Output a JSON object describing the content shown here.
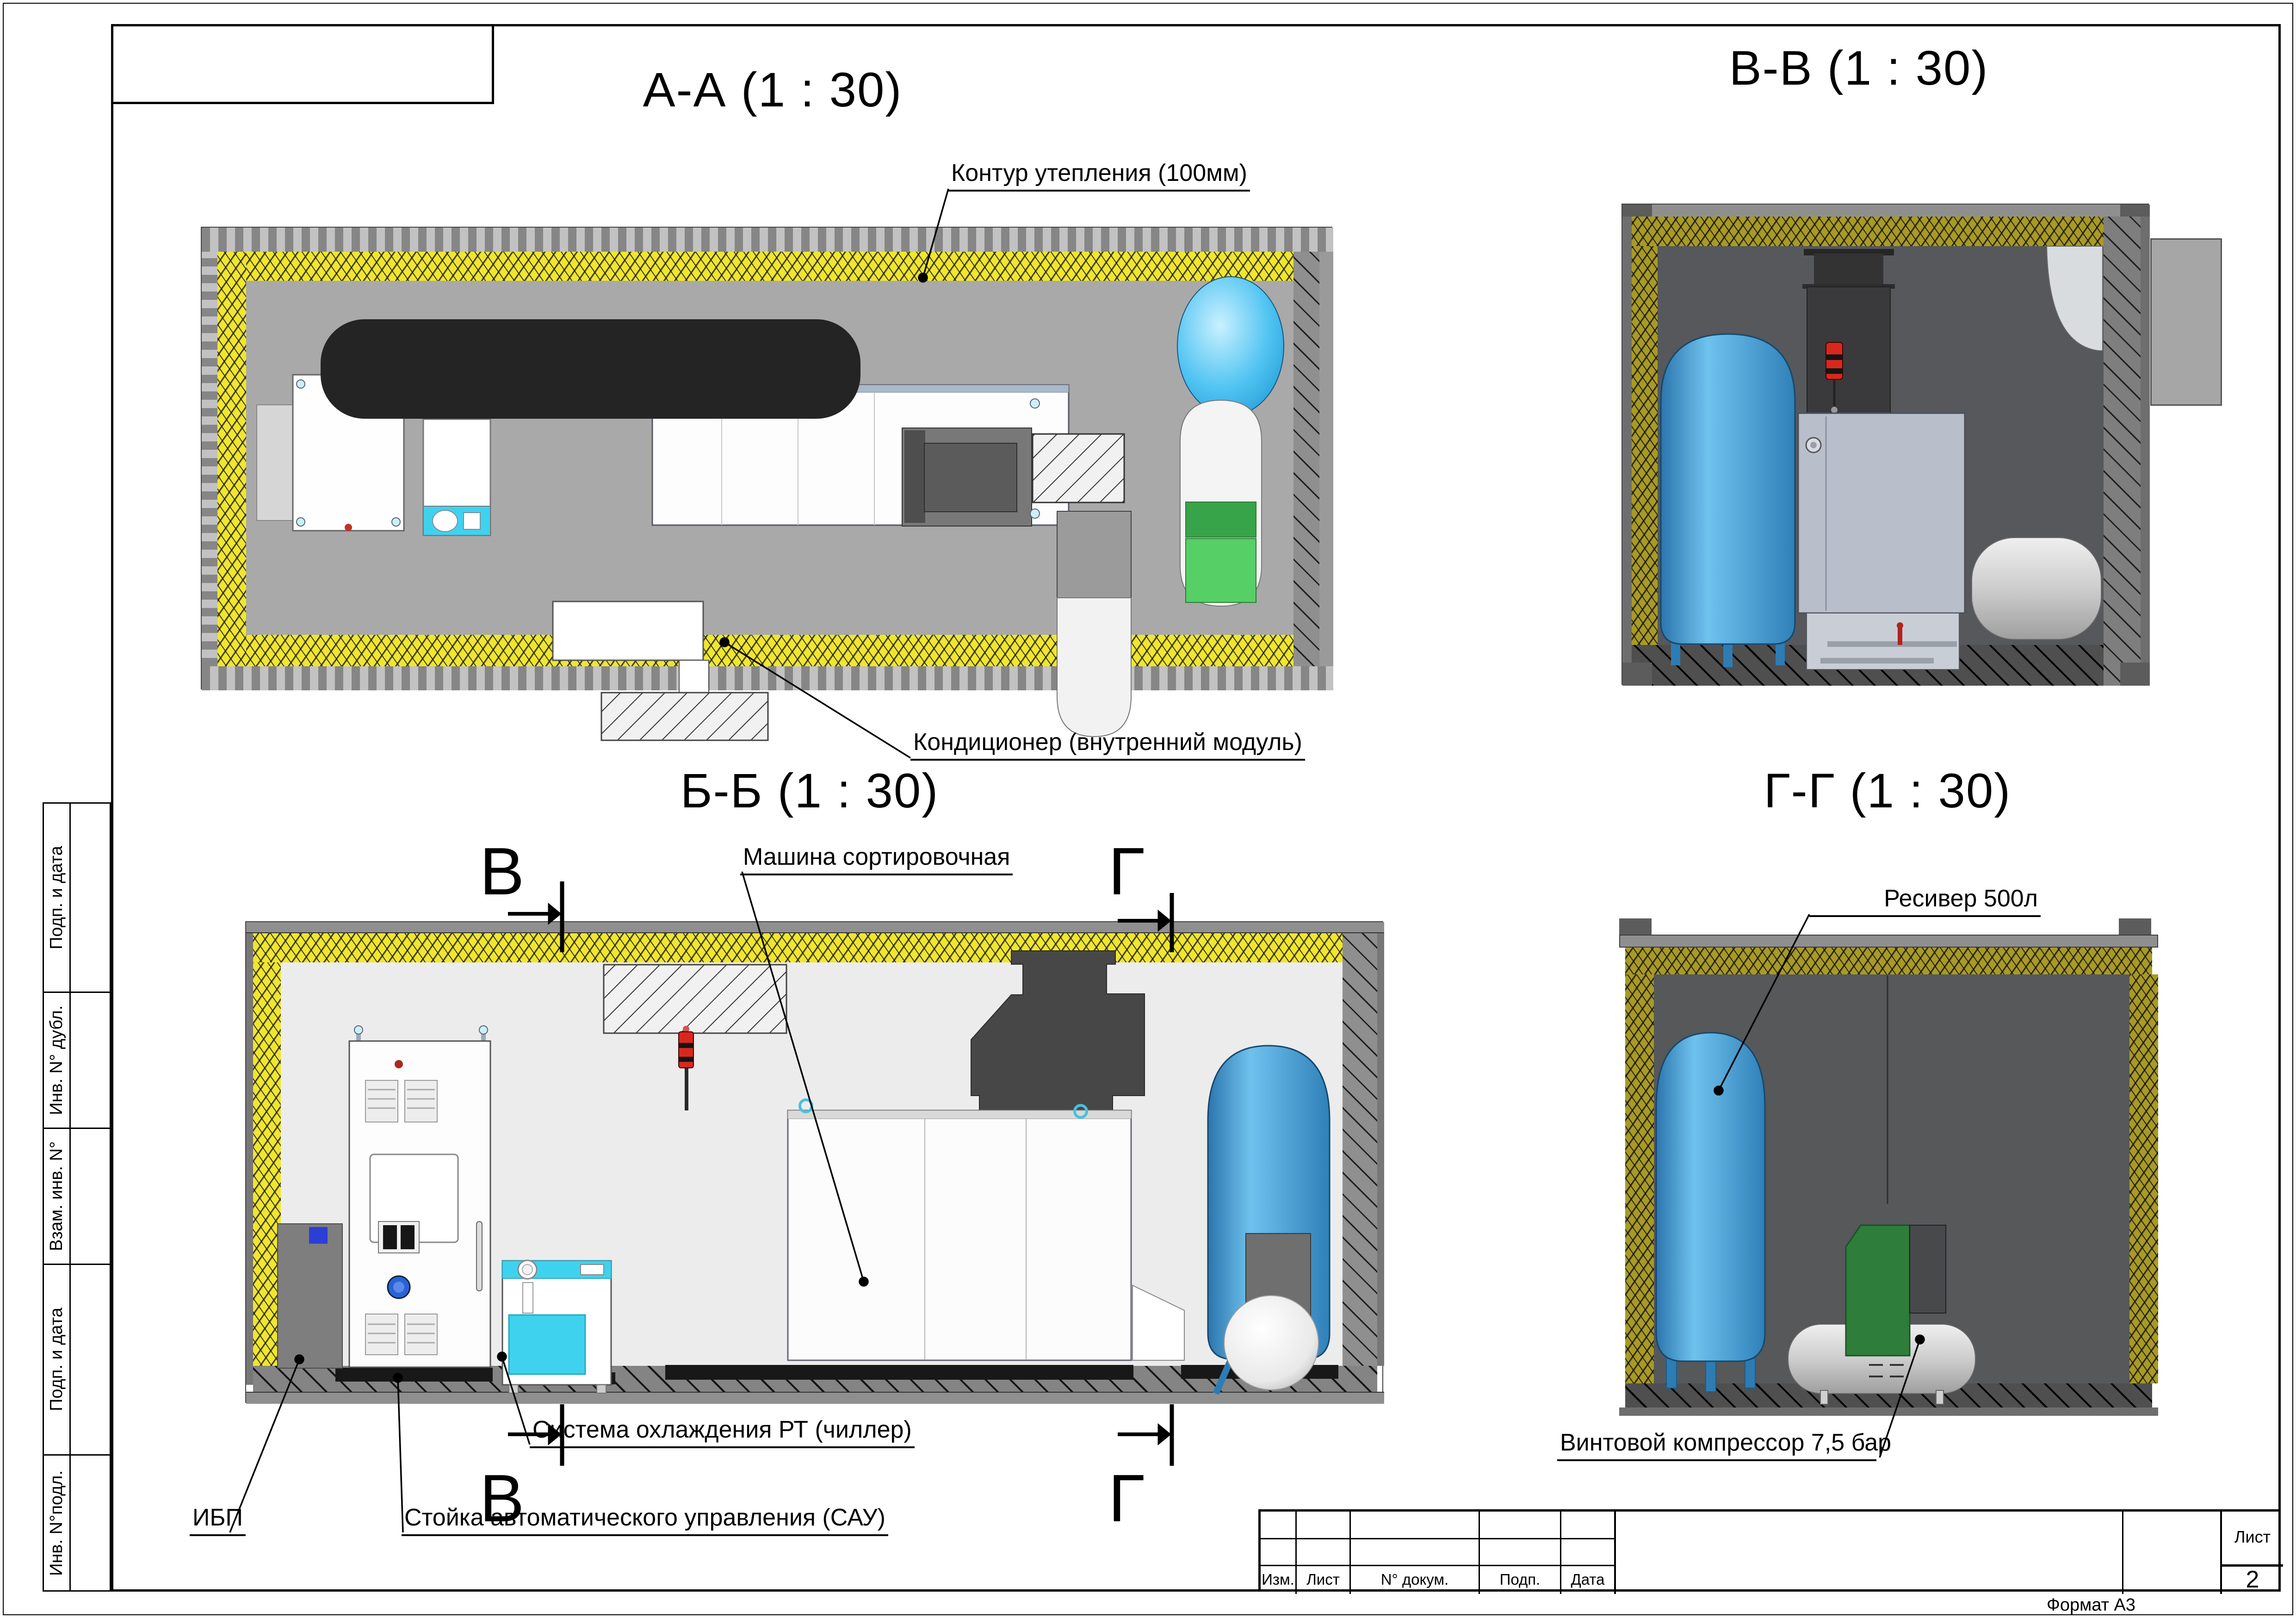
{
  "view_titles": {
    "aa": "А-А (1 : 30)",
    "vv": "В-В (1 : 30)",
    "bb": "Б-Б (1 : 30)",
    "gg": "Г-Г (1 : 30)"
  },
  "annotations": {
    "insulation": "Контур утепления (100мм)",
    "ac_indoor": "Кондиционер (внутренний модуль)",
    "sorting_machine": "Машина сортировочная",
    "chiller": "Система охлаждения РТ (чиллер)",
    "ups": "ИБП",
    "control_rack": "Стойка автоматического управления (САУ)",
    "receiver": "Ресивер 500л",
    "compressor": "Винтовой компрессор 7,5 бар"
  },
  "section_markers": {
    "v": "В",
    "g": "Г"
  },
  "title_block": {
    "columns": [
      "Изм.",
      "Лист",
      "N° докум.",
      "Подп.",
      "Дата"
    ],
    "sheet_label": "Лист",
    "sheet_number": "2",
    "format_note": "Формат А3"
  },
  "sidebar": {
    "items": [
      "Подп. и дата",
      "Инв. N° дубл.",
      "Взам. инв. N°",
      "Подп. и дата",
      "Инв. N°подл."
    ]
  },
  "colors": {
    "insulation_yellow": "#f0e62e",
    "insulation_olive": "#a89a25",
    "tank_blue": "#3f8fc9",
    "chiller_cyan": "#3fd2ef",
    "compressor_green": "#2e7d3a",
    "tank_panel_green": "#3f9e4d",
    "signal_lamp_red": "#d8281e",
    "duct_black": "#242424"
  }
}
